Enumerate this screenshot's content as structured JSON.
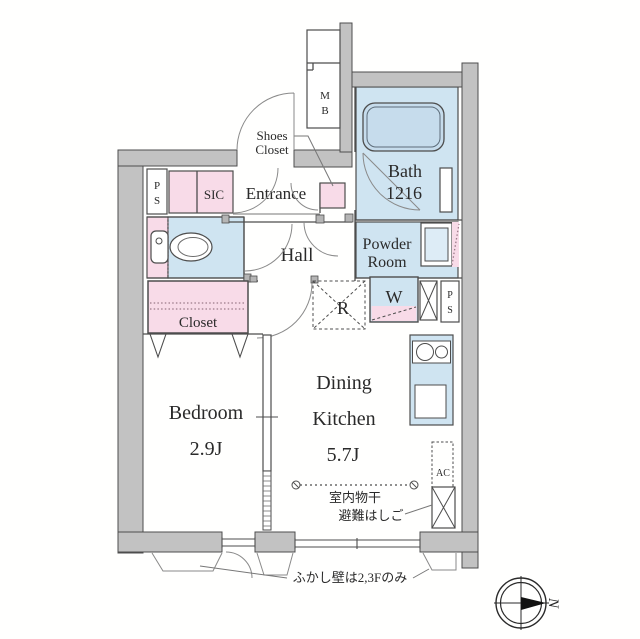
{
  "rooms": {
    "entrance": {
      "label": "Entrance"
    },
    "hall": {
      "label": "Hall"
    },
    "bath": {
      "name": "Bath",
      "size": "1216"
    },
    "powder_room": {
      "line1": "Powder",
      "line2": "Room"
    },
    "closet": {
      "label": "Closet"
    },
    "sic": {
      "label": "SIC"
    },
    "shoes_closet": {
      "line1": "Shoes",
      "line2": "Closet"
    },
    "bedroom": {
      "name": "Bedroom",
      "size": "2.9J"
    },
    "dining_kitchen": {
      "line1": "Dining",
      "line2": "Kitchen",
      "size": "5.7J"
    }
  },
  "fixtures": {
    "meter_box": {
      "line1": "M",
      "line2": "B"
    },
    "pipe_shaft_top": {
      "line1": "P",
      "line2": "S"
    },
    "pipe_shaft_right": {
      "line1": "P",
      "line2": "S"
    },
    "washer": {
      "label": "W"
    },
    "refrigerator": {
      "label": "R"
    },
    "air_conditioner": {
      "label": "AC"
    }
  },
  "annotations": {
    "indoor_drying": "室内物干",
    "escape_ladder": "避難はしご",
    "wall_note": "ふかし壁は2,3Fのみ",
    "compass_north": "N"
  },
  "colors": {
    "wall_fill": "#c2c2c2",
    "outline": "#4d4d4d",
    "room_pink": "#f8dbe8",
    "room_blue": "#cfe4f1",
    "tub_blue": "#c6dcec",
    "text": "#2a2a2a"
  }
}
